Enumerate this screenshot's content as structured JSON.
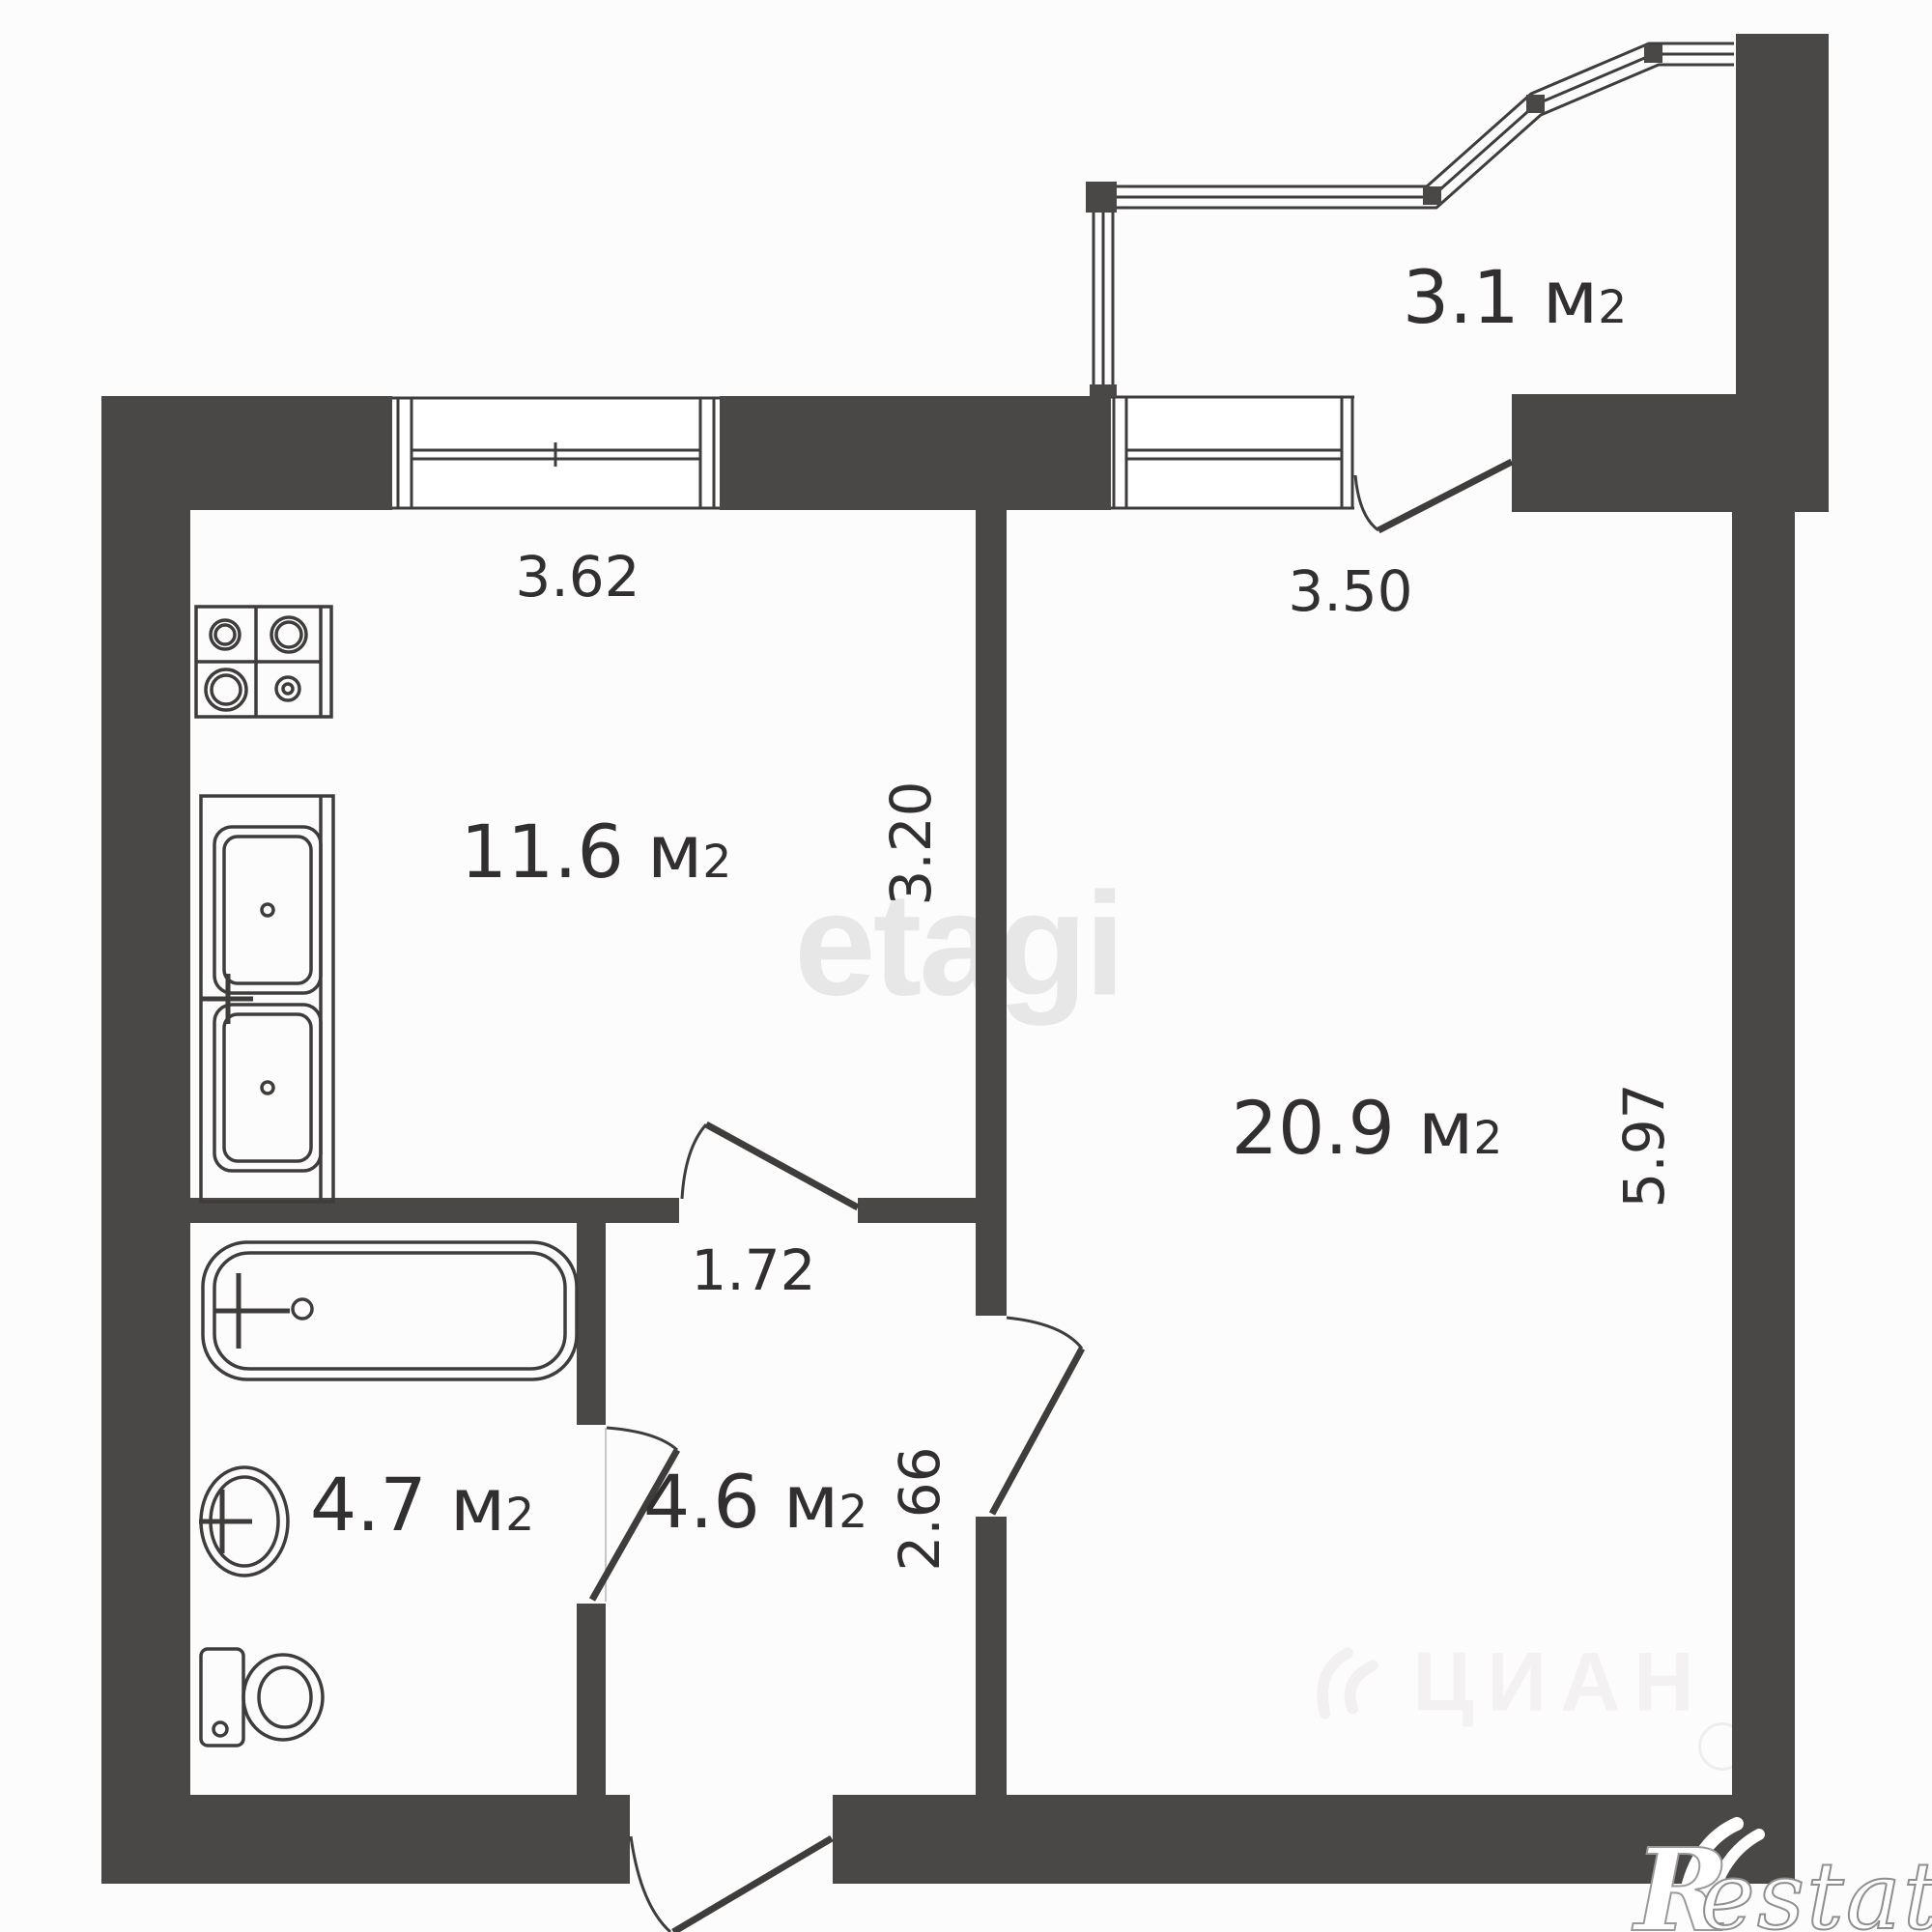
{
  "watermarks": {
    "center": "etagi",
    "listing": "ЦИАН",
    "logo_r": "R",
    "logo_rest": "estate"
  },
  "rooms": {
    "kitchen": {
      "area": "11.6",
      "unit_base": "м",
      "unit_exp": "2"
    },
    "living": {
      "area": "20.9",
      "unit_base": "м",
      "unit_exp": "2"
    },
    "bathroom": {
      "area": "4.7",
      "unit_base": "м",
      "unit_exp": "2"
    },
    "hallway": {
      "area": "4.6",
      "unit_base": "м",
      "unit_exp": "2"
    },
    "balcony": {
      "area": "3.1",
      "unit_base": "м",
      "unit_exp": "2"
    }
  },
  "dimensions": {
    "kitchen_width": {
      "label": "3.62"
    },
    "kitchen_depth": {
      "label": "3.20"
    },
    "living_width": {
      "label": "3.50"
    },
    "living_depth": {
      "label": "5.97"
    },
    "hallway_width": {
      "label": "1.72"
    },
    "hallway_depth": {
      "label": "2.66"
    }
  },
  "colors": {
    "wall": "#4a4747",
    "line": "#3f3c3c",
    "label": "#312f2f",
    "watermark": "#e8e7e7",
    "watermark_faint": "#f3f1f1",
    "background": "#fdfcfc"
  }
}
